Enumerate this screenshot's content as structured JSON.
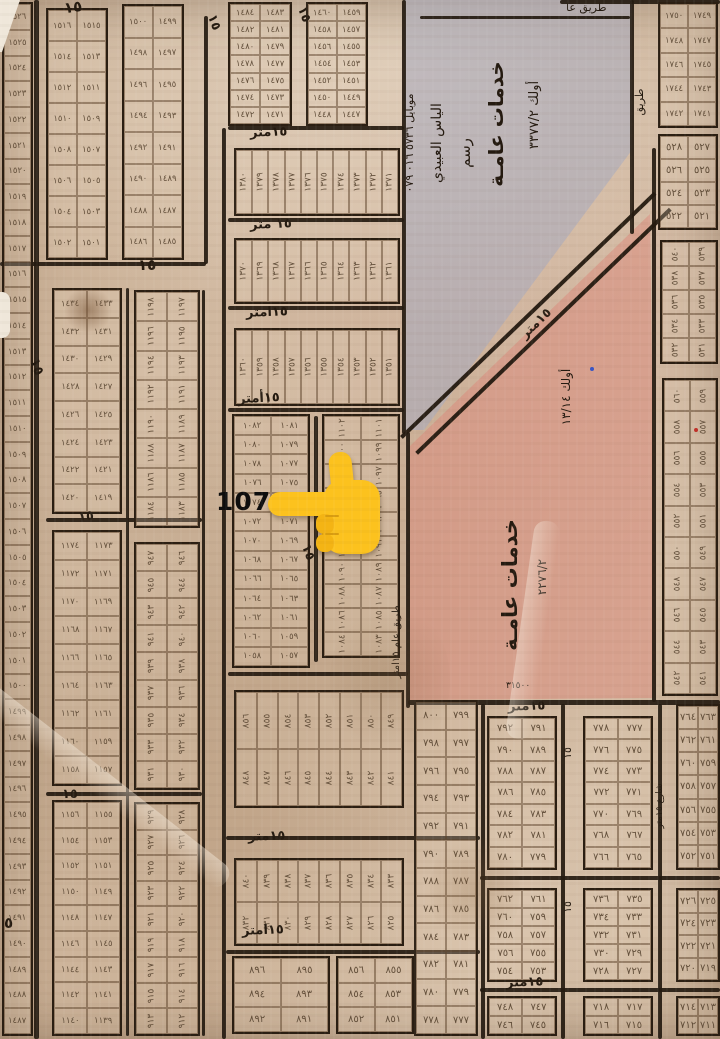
{
  "map": {
    "type": "cadastral-plan-scan",
    "numerals": "arabic-indic",
    "pointer": {
      "label": "1074",
      "points_at_plot": 1074
    },
    "zones": [
      {
        "id": "services-top",
        "fill": "rgba(166,170,192,0.55)",
        "points": [
          [
            404,
            0
          ],
          [
            632,
            0
          ],
          [
            632,
            150
          ],
          [
            424,
            430
          ],
          [
            404,
            430
          ]
        ],
        "texts": [
          {
            "t": "أولك  ٣٣٧٧/٢",
            "x": 528,
            "y": 215,
            "rot": -90,
            "size": 13,
            "len": 200
          },
          {
            "t": "خدمات عامـة",
            "x": 486,
            "y": 220,
            "rot": -90,
            "size": 20,
            "len": 192,
            "bold": true
          },
          {
            "t": "رسم",
            "x": 458,
            "y": 188,
            "rot": -90,
            "size": 15,
            "len": 70
          },
          {
            "t": "الياس العبيدي",
            "x": 430,
            "y": 238,
            "rot": -90,
            "size": 14,
            "len": 190
          },
          {
            "t": "موبايل ٥٧٣٦ ٠١٦ ٠٧٩",
            "x": 404,
            "y": 262,
            "rot": -90,
            "size": 11,
            "len": 238
          }
        ]
      },
      {
        "id": "services-mid",
        "fill": "rgba(219,136,122,0.5)",
        "points": [
          [
            410,
            446
          ],
          [
            650,
            214
          ],
          [
            656,
            698
          ],
          [
            410,
            700
          ]
        ],
        "texts": [
          {
            "t": "أولك ١٣/١٤",
            "x": 560,
            "y": 452,
            "rot": -90,
            "size": 12,
            "len": 110
          },
          {
            "t": "٢٢٧٦/٢",
            "x": 536,
            "y": 632,
            "rot": -90,
            "size": 12,
            "len": 110
          },
          {
            "t": "خدمات عامـة",
            "x": 500,
            "y": 706,
            "rot": -90,
            "size": 21,
            "len": 242,
            "bold": true
          },
          {
            "t": "٣١٥٠٠",
            "x": 506,
            "y": 682,
            "rot": 0,
            "size": 9
          }
        ]
      }
    ],
    "diagonal_road": {
      "x": 400,
      "y": 436,
      "len": 352,
      "w": 18,
      "angle": -43.9,
      "label": "١٥متر"
    },
    "street_labels": [
      {
        "t": "١٥",
        "x": 64,
        "y": 0,
        "rot": -8,
        "size": 15,
        "bold": true
      },
      {
        "t": "١٥",
        "x": 206,
        "y": 16,
        "rot": 70,
        "size": 13,
        "bold": true
      },
      {
        "t": "١٥",
        "x": 296,
        "y": 8,
        "rot": 70,
        "size": 13,
        "bold": true
      },
      {
        "t": "١٥",
        "x": 138,
        "y": 258,
        "rot": 0,
        "size": 15,
        "bold": true
      },
      {
        "t": "١٥متر",
        "x": 250,
        "y": 126,
        "rot": -2,
        "size": 13,
        "bold": true
      },
      {
        "t": "١٥ متر",
        "x": 250,
        "y": 218,
        "rot": -2,
        "size": 13,
        "bold": true
      },
      {
        "t": "١٥امتر",
        "x": 246,
        "y": 306,
        "rot": -2,
        "size": 13,
        "bold": true
      },
      {
        "t": "١٥أمتر",
        "x": 238,
        "y": 392,
        "rot": -3,
        "size": 13,
        "bold": true
      },
      {
        "t": "١٥",
        "x": 28,
        "y": 360,
        "rot": 70,
        "size": 14,
        "bold": true
      },
      {
        "t": "١٥",
        "x": 78,
        "y": 510,
        "rot": -5,
        "size": 13,
        "bold": true
      },
      {
        "t": "١٥",
        "x": 62,
        "y": 788,
        "rot": 0,
        "size": 13,
        "bold": true
      },
      {
        "t": "٥",
        "x": 4,
        "y": 916,
        "rot": 0,
        "size": 15,
        "bold": true
      },
      {
        "t": "١٥",
        "x": 300,
        "y": 546,
        "rot": 70,
        "size": 13,
        "bold": true
      },
      {
        "t": "١٥متر",
        "x": 248,
        "y": 830,
        "rot": -2,
        "size": 13,
        "bold": true
      },
      {
        "t": "١٥امتر",
        "x": 242,
        "y": 924,
        "rot": -2,
        "size": 13,
        "bold": true
      },
      {
        "t": "طريق عام ١٥امتر",
        "x": 392,
        "y": 748,
        "rot": -90,
        "size": 10,
        "len": 212
      },
      {
        "t": "١٥متر",
        "x": 508,
        "y": 700,
        "rot": -2,
        "size": 13,
        "bold": true
      },
      {
        "t": "١٥متر",
        "x": 506,
        "y": 976,
        "rot": -2,
        "size": 13,
        "bold": true
      },
      {
        "t": "طريق عا",
        "x": 566,
        "y": 2,
        "rot": 0,
        "size": 11
      },
      {
        "t": "طريق",
        "x": 634,
        "y": 150,
        "rot": -90,
        "size": 11,
        "len": 96
      },
      {
        "t": "١٥",
        "x": 562,
        "y": 768,
        "rot": -90,
        "size": 11,
        "len": 30
      },
      {
        "t": "١٥",
        "x": 562,
        "y": 922,
        "rot": -90,
        "size": 11,
        "len": 30
      },
      {
        "t": "شارع ١٥متر",
        "x": 656,
        "y": 862,
        "rot": -90,
        "size": 9,
        "len": 112
      }
    ],
    "grids": [
      {
        "id": "strip-a",
        "x": 2,
        "y": 2,
        "w": 31,
        "h": 1034,
        "cols": 1,
        "rows": 40,
        "from": 1526
      },
      {
        "id": "a2",
        "x": 46,
        "y": 8,
        "w": 62,
        "h": 252,
        "cols": 2,
        "rows": 8,
        "from": 1516
      },
      {
        "id": "a3",
        "x": 122,
        "y": 4,
        "w": 62,
        "h": 256,
        "cols": 2,
        "rows": 8,
        "from": 1500
      },
      {
        "id": "a4",
        "x": 228,
        "y": 2,
        "w": 64,
        "h": 124,
        "cols": 2,
        "rows": 7,
        "from": 1484
      },
      {
        "id": "a5",
        "x": 306,
        "y": 2,
        "w": 62,
        "h": 124,
        "cols": 2,
        "rows": 7,
        "from": 1460
      },
      {
        "id": "b1",
        "x": 52,
        "y": 288,
        "w": 70,
        "h": 226,
        "cols": 2,
        "rows": 8,
        "from": 1434
      },
      {
        "id": "b2",
        "x": 52,
        "y": 530,
        "w": 70,
        "h": 256,
        "cols": 2,
        "rows": 9,
        "from": 1174
      },
      {
        "id": "b3",
        "x": 52,
        "y": 800,
        "w": 70,
        "h": 236,
        "cols": 2,
        "rows": 9,
        "from": 1156
      },
      {
        "id": "c2",
        "x": 134,
        "y": 290,
        "w": 66,
        "h": 238,
        "cols": 2,
        "rows": 8,
        "from": 1198,
        "rot": true
      },
      {
        "id": "c3",
        "x": 134,
        "y": 542,
        "w": 66,
        "h": 248,
        "cols": 2,
        "rows": 9,
        "from": 947,
        "rot": true
      },
      {
        "id": "c4",
        "x": 134,
        "y": 802,
        "w": 66,
        "h": 234,
        "cols": 2,
        "rows": 9,
        "from": 929,
        "rot": true
      },
      {
        "id": "m2",
        "x": 234,
        "y": 148,
        "w": 166,
        "h": 68,
        "cols": 10,
        "rows": 1,
        "from": 1380,
        "rot": true
      },
      {
        "id": "m3",
        "x": 234,
        "y": 238,
        "w": 166,
        "h": 66,
        "cols": 10,
        "rows": 1,
        "from": 1370,
        "rot": true
      },
      {
        "id": "m4",
        "x": 234,
        "y": 328,
        "w": 166,
        "h": 78,
        "cols": 10,
        "rows": 1,
        "from": 1360,
        "rot": true
      },
      {
        "id": "focal",
        "x": 232,
        "y": 414,
        "w": 78,
        "h": 254,
        "cols": 2,
        "rows": 13,
        "from": 1082
      },
      {
        "id": "e1",
        "x": 322,
        "y": 414,
        "w": 78,
        "h": 244,
        "cols": 2,
        "rows": 10,
        "from": 1102,
        "rot": true
      },
      {
        "id": "m6",
        "x": 234,
        "y": 690,
        "w": 170,
        "h": 118,
        "cols": 8,
        "rows": 2,
        "from": 856,
        "rot": true
      },
      {
        "id": "m7",
        "x": 234,
        "y": 858,
        "w": 170,
        "h": 88,
        "cols": 8,
        "rows": 2,
        "from": 840,
        "rot": true
      },
      {
        "id": "m8a",
        "x": 232,
        "y": 956,
        "w": 98,
        "h": 78,
        "cols": 2,
        "rows": 3,
        "from": 896
      },
      {
        "id": "m8b",
        "x": 336,
        "y": 956,
        "w": 78,
        "h": 78,
        "cols": 2,
        "rows": 3,
        "from": 856
      },
      {
        "id": "m9",
        "x": 414,
        "y": 700,
        "w": 64,
        "h": 336,
        "cols": 2,
        "rows": 12,
        "from": 800
      },
      {
        "id": "r1",
        "x": 658,
        "y": 2,
        "w": 60,
        "h": 126,
        "cols": 2,
        "rows": 5,
        "from": 1750
      },
      {
        "id": "r2",
        "x": 658,
        "y": 134,
        "w": 60,
        "h": 96,
        "cols": 2,
        "rows": 4,
        "from": 528
      },
      {
        "id": "r3",
        "x": 660,
        "y": 240,
        "w": 58,
        "h": 124,
        "cols": 2,
        "rows": 5,
        "from": 540,
        "rot": true
      },
      {
        "id": "r4",
        "x": 662,
        "y": 378,
        "w": 56,
        "h": 318,
        "cols": 2,
        "rows": 10,
        "from": 560,
        "rot": true
      },
      {
        "id": "br1",
        "x": 487,
        "y": 716,
        "w": 70,
        "h": 154,
        "cols": 2,
        "rows": 7,
        "from": 792
      },
      {
        "id": "br2",
        "x": 583,
        "y": 716,
        "w": 70,
        "h": 154,
        "cols": 2,
        "rows": 7,
        "from": 778
      },
      {
        "id": "br3",
        "x": 676,
        "y": 704,
        "w": 44,
        "h": 166,
        "cols": 2,
        "rows": 7,
        "from": 764
      },
      {
        "id": "br4",
        "x": 487,
        "y": 888,
        "w": 70,
        "h": 94,
        "cols": 2,
        "rows": 5,
        "from": 762
      },
      {
        "id": "br5",
        "x": 583,
        "y": 888,
        "w": 70,
        "h": 94,
        "cols": 2,
        "rows": 5,
        "from": 736
      },
      {
        "id": "br6",
        "x": 676,
        "y": 888,
        "w": 44,
        "h": 94,
        "cols": 2,
        "rows": 4,
        "from": 726
      },
      {
        "id": "br7",
        "x": 487,
        "y": 996,
        "w": 70,
        "h": 40,
        "cols": 2,
        "rows": 2,
        "from": 748
      },
      {
        "id": "br8",
        "x": 583,
        "y": 996,
        "w": 70,
        "h": 40,
        "cols": 2,
        "rows": 2,
        "from": 718
      },
      {
        "id": "br9",
        "x": 676,
        "y": 996,
        "w": 44,
        "h": 40,
        "cols": 2,
        "rows": 2,
        "from": 714
      }
    ],
    "roads": [
      [
        34,
        0,
        5,
        1039
      ],
      [
        204,
        16,
        4,
        248
      ],
      [
        0,
        262,
        206,
        4
      ],
      [
        222,
        128,
        4,
        911
      ],
      [
        126,
        288,
        3,
        748
      ],
      [
        202,
        290,
        3,
        746
      ],
      [
        46,
        518,
        156,
        4
      ],
      [
        46,
        792,
        156,
        4
      ],
      [
        228,
        126,
        176,
        4
      ],
      [
        228,
        218,
        176,
        4
      ],
      [
        228,
        306,
        176,
        4
      ],
      [
        228,
        408,
        176,
        4
      ],
      [
        228,
        672,
        180,
        4
      ],
      [
        226,
        836,
        254,
        4
      ],
      [
        226,
        950,
        254,
        4
      ],
      [
        314,
        416,
        4,
        246
      ],
      [
        402,
        0,
        4,
        434
      ],
      [
        406,
        432,
        4,
        276
      ],
      [
        420,
        16,
        210,
        3
      ],
      [
        630,
        0,
        4,
        234
      ],
      [
        652,
        148,
        4,
        554
      ],
      [
        560,
        0,
        160,
        4
      ],
      [
        408,
        700,
        312,
        5
      ],
      [
        481,
        704,
        4,
        335
      ],
      [
        561,
        704,
        4,
        335
      ],
      [
        658,
        704,
        4,
        335
      ],
      [
        480,
        876,
        240,
        4
      ],
      [
        480,
        988,
        240,
        4
      ]
    ],
    "marks": [
      {
        "x": 694,
        "y": 428,
        "color": "#c03028"
      },
      {
        "x": 590,
        "y": 367,
        "color": "#3a56c4"
      }
    ]
  }
}
